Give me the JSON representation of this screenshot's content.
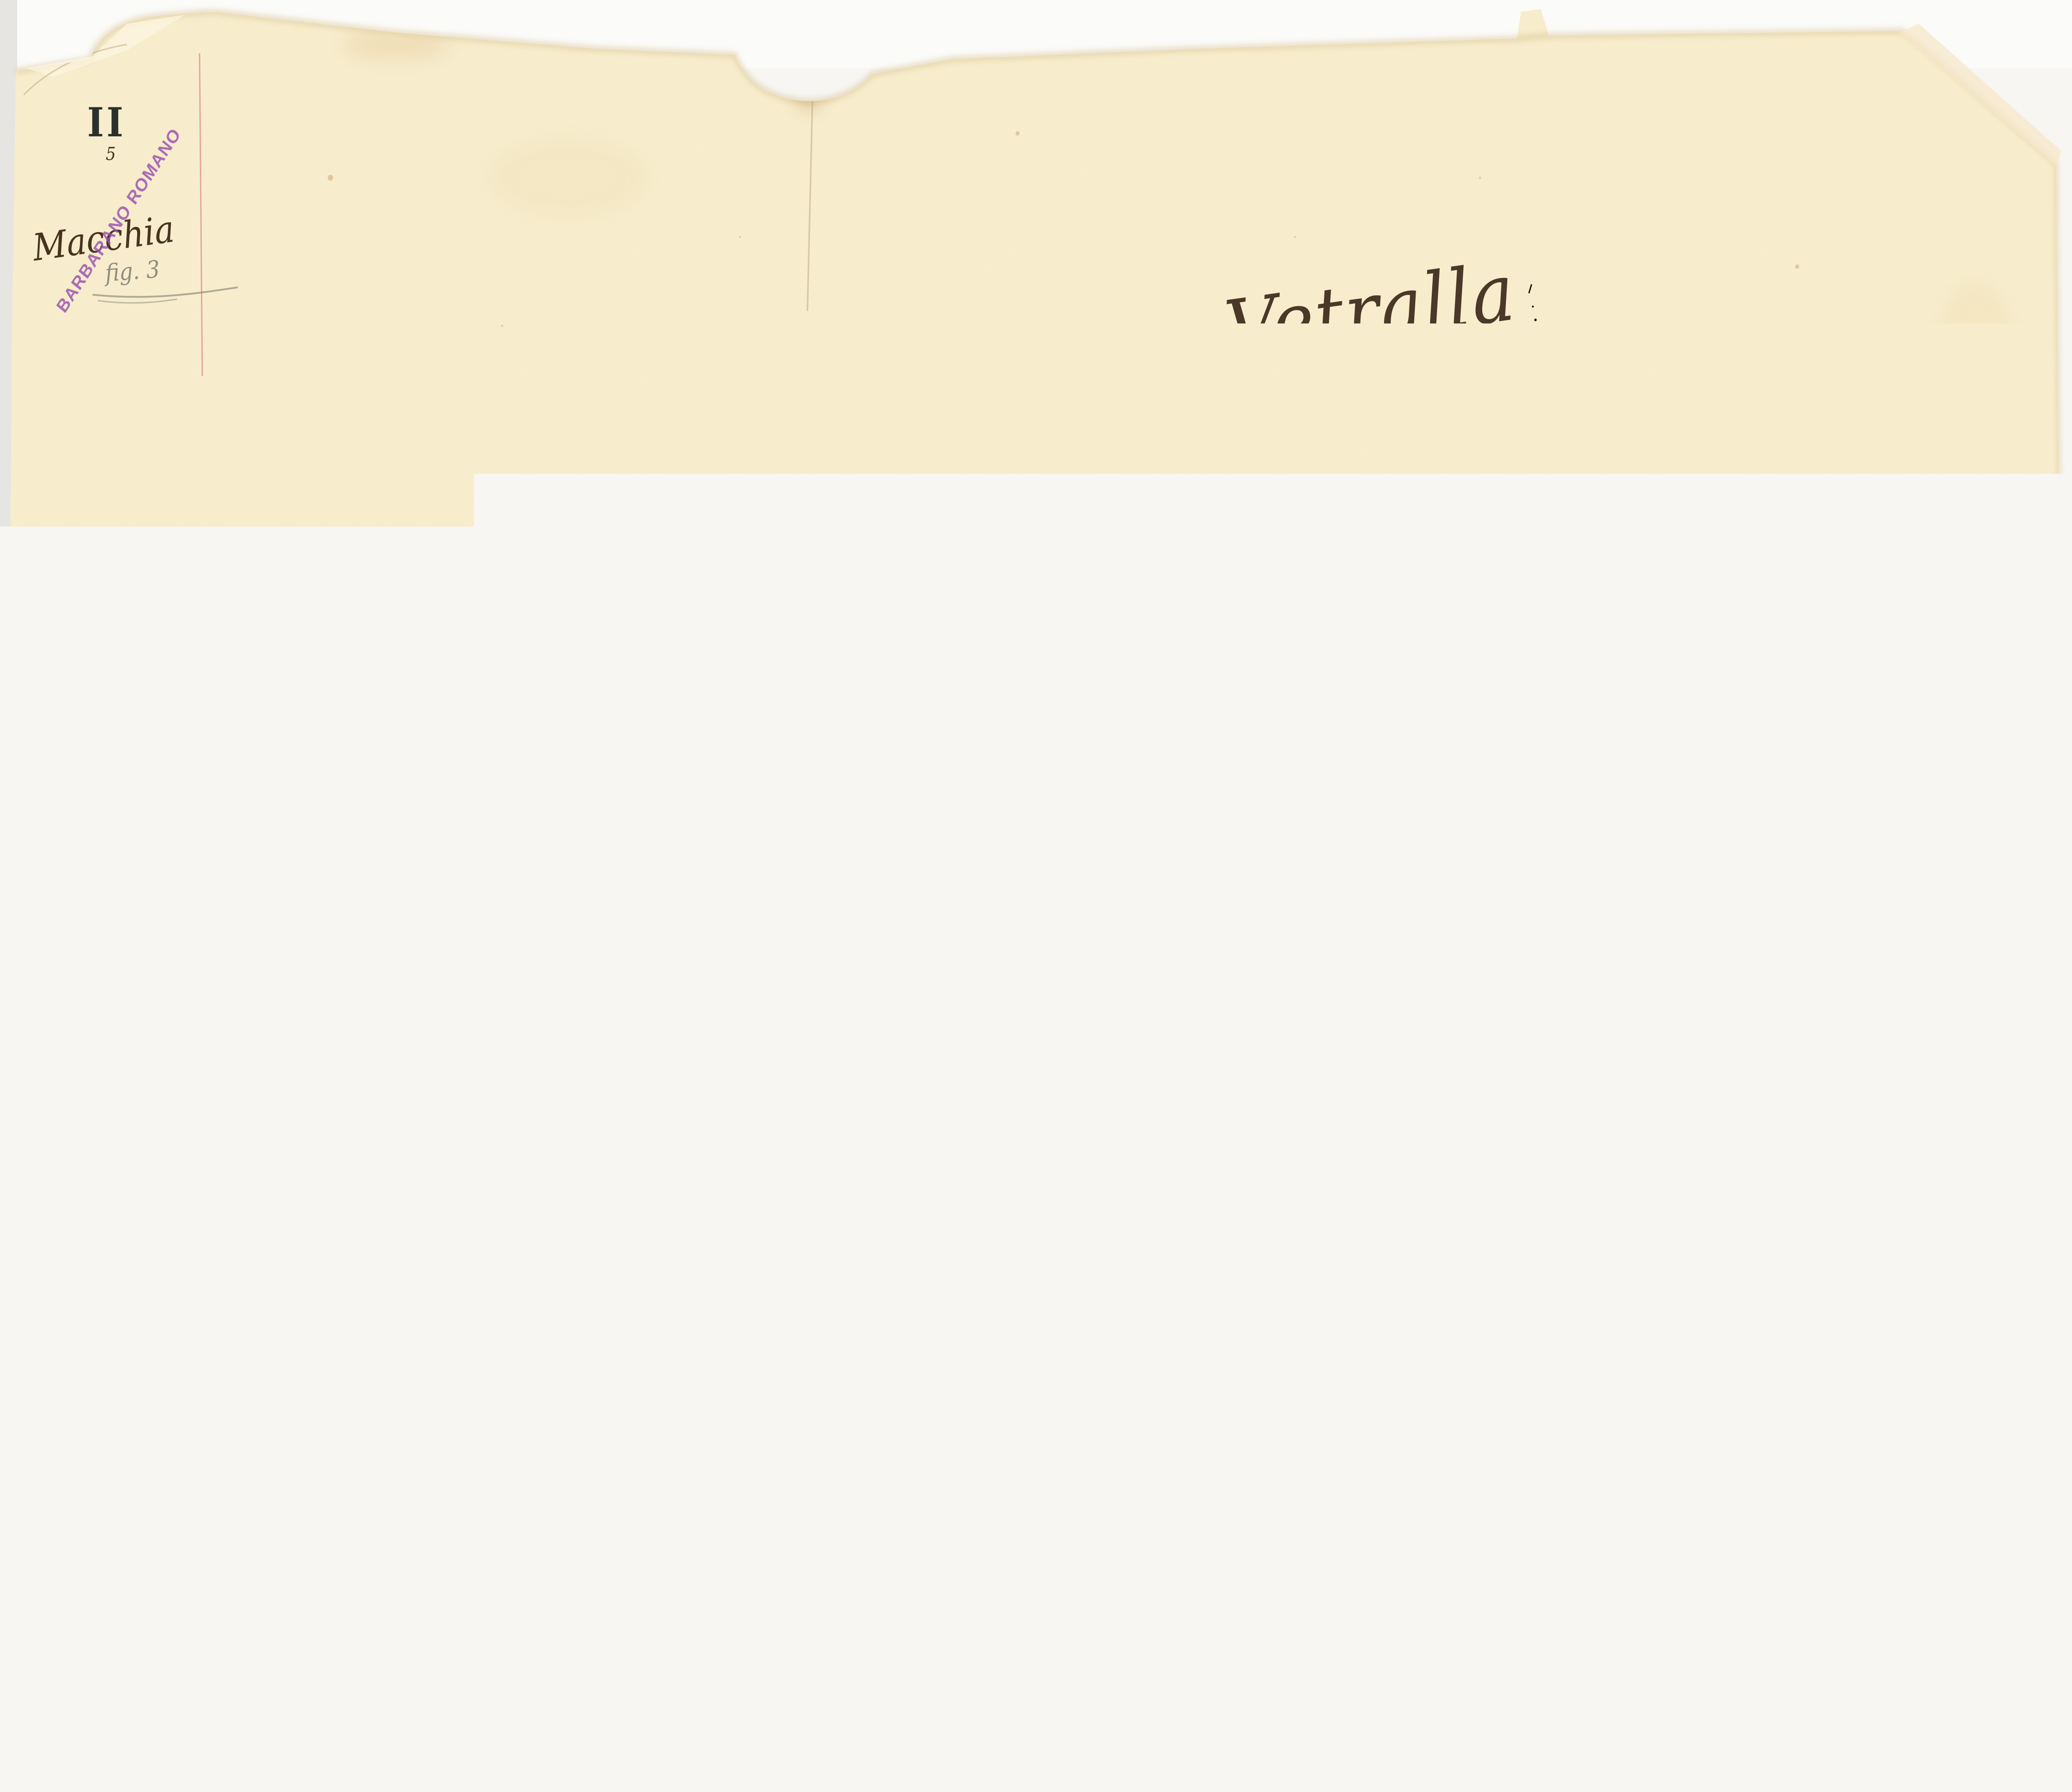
{
  "map": {
    "sheet_number": "II",
    "sheet_sub": "5",
    "region_label": "Macchia",
    "pencil_note": "fig. 3",
    "stamp_text": "BARBARANO ROMANO",
    "title": {
      "word1": "Sezione",
      "word2": "di",
      "word3": "Vetralla"
    },
    "labels": {
      "stream": "Vall'",
      "locality": "Torricella",
      "marker_letter": "T",
      "building_1": "1. Sub.º 2.",
      "building_2": "1. Sub.º 3.",
      "building_3": "1. Sub.º 4."
    },
    "circled_number": "4",
    "parcel_numbers": [
      {
        "value": "7."
      },
      {
        "value": "12."
      },
      {
        "value": "26."
      },
      {
        "value": "15."
      },
      {
        "value": "25."
      },
      {
        "value": "13."
      },
      {
        "value": "6."
      },
      {
        "value": "14."
      },
      {
        "value": "16."
      }
    ],
    "colors": {
      "scanner_bg": "#f7f6f3",
      "sleeve": "#dbdad4",
      "paper": "#f8eecd",
      "paper_edge": "#dcc79c",
      "ink": "#47341f",
      "title_ink": "#4a3828",
      "parcel_line": "#6b5337",
      "pencil": "#908c7f",
      "margin_line": "#d98b8b",
      "red_ink": "#cf5670",
      "river": "#8cbfa4",
      "river_highlight": "#b7d5bf",
      "river_outline": "#4d4231",
      "river_fringe": "#dcc89b",
      "road": "#f6dfc6",
      "road_edge": "#6b5844",
      "green_band": "#7fb36d",
      "green_band_light": "#b7d69c",
      "band_fringe": "#e6d9a0",
      "yellow_band": "#eecf3e",
      "yellow_band_light": "#f6e07a",
      "boundary_dash": "#1d160d",
      "stamp": "#9c50b0",
      "stream_label": "#7c2a1e"
    }
  }
}
